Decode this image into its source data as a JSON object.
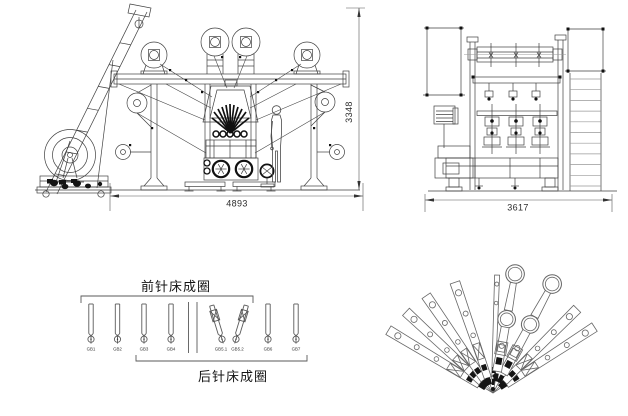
{
  "drawing": {
    "dimensions": {
      "front_width": "4893",
      "front_height": "3348",
      "side_width": "3617"
    },
    "guide_bar_diagram": {
      "front_bed_label": "前针床成圈",
      "rear_bed_label": "后针床成圈",
      "bars": [
        {
          "id": "GB1"
        },
        {
          "id": "GB2"
        },
        {
          "id": "GB3"
        },
        {
          "id": "GB4"
        },
        {
          "id": "GB5.1"
        },
        {
          "id": "GB5.2"
        },
        {
          "id": "GB6"
        },
        {
          "id": "GB7"
        }
      ]
    },
    "fan_diagram": {
      "arms": [
        {
          "deg": -59,
          "len": 122,
          "type": "plain"
        },
        {
          "deg": -47,
          "len": 119,
          "type": "plain"
        },
        {
          "deg": -34.5,
          "len": 118,
          "type": "plain"
        },
        {
          "deg": -19,
          "len": 117,
          "type": "plain"
        },
        {
          "deg": 2,
          "len": 118,
          "type": "thin"
        },
        {
          "deg": 10.5,
          "len": 130,
          "type": "ring"
        },
        {
          "deg": 28.5,
          "len": 133,
          "type": "ring"
        },
        {
          "deg": 45,
          "len": 119,
          "type": "plain"
        },
        {
          "deg": 57,
          "len": 121,
          "type": "plain"
        }
      ]
    },
    "colors": {
      "line": "#3f3f3f",
      "light_line": "#8a8a8a",
      "dark": "#141414"
    }
  }
}
